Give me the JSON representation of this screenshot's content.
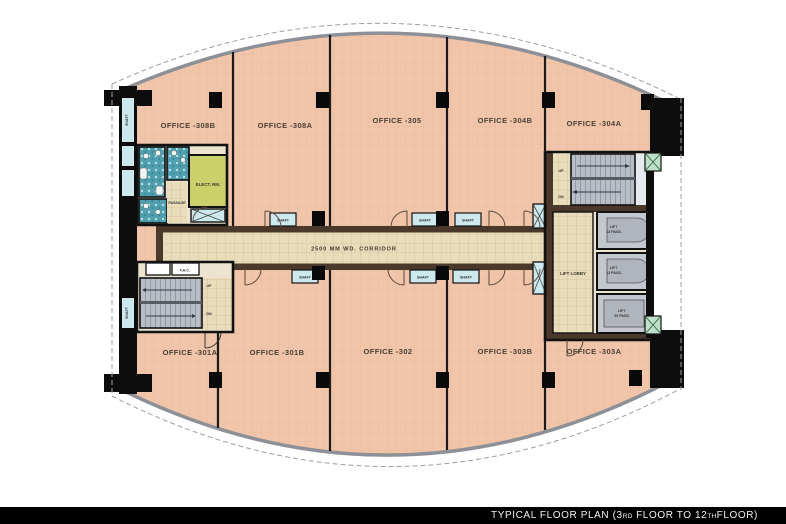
{
  "title_bar": {
    "prefix": "TYPICAL FLOOR PLAN (3",
    "ord1": "RD",
    "mid": " FLOOR TO 12",
    "ord2": "TH",
    "suffix": " FLOOR)"
  },
  "colors": {
    "office_fill": "#f1c5aa",
    "corridor_fill": "#e9dcba",
    "corridor_wall_brown": "#4a392b",
    "wall_black": "#0d0d0d",
    "stair_gray": "#b9bec6",
    "toilet_teal": "#4f9fae",
    "elect_green": "#ccd06b",
    "shaft_blue": "#cde9ee",
    "duct_green": "#bfe0c8",
    "facade_gray": "#8d9096",
    "titlebar_bg": "#000000",
    "titlebar_text": "#f2f2f2"
  },
  "offices_top": [
    {
      "label": "OFFICE -308B"
    },
    {
      "label": "OFFICE -308A"
    },
    {
      "label": "OFFICE -305"
    },
    {
      "label": "OFFICE -304B"
    },
    {
      "label": "OFFICE -304A"
    }
  ],
  "offices_bottom": [
    {
      "label": "OFFICE -301A"
    },
    {
      "label": "OFFICE -301B"
    },
    {
      "label": "OFFICE -302"
    },
    {
      "label": "OFFICE -303B"
    },
    {
      "label": "OFFICE -303A"
    }
  ],
  "corridor_label": "2500 MM WD. CORRIDOR",
  "core": {
    "lift_lobby": "LIFT LOBBY",
    "lifts": [
      {
        "line1": "LIFT",
        "line2": "13 PASS."
      },
      {
        "line1": "LIFT",
        "line2": "13 PASS."
      },
      {
        "line1": "LIFT",
        "line2": "20 PASS."
      }
    ],
    "elect_room": "ELECT. RM.",
    "passage": "PASSAGE",
    "fhc": "F.H.C.",
    "up": "UP",
    "dn": "DN",
    "shaft": "SHAFT"
  }
}
